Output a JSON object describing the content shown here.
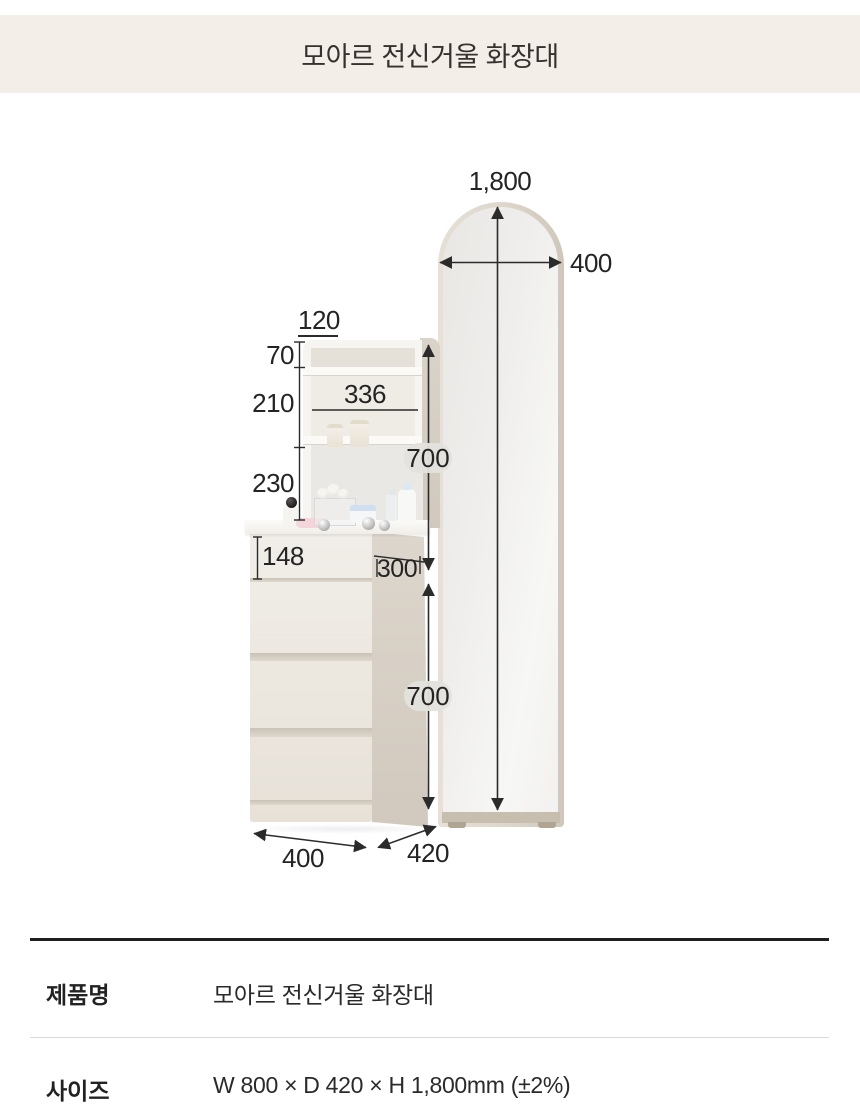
{
  "header": {
    "title": "모아르 전신거울 화장대"
  },
  "colors": {
    "header_bg": "#f4eee9",
    "furniture_ivory": "#f1eee9",
    "furniture_taupe": "#d5cdc2",
    "mirror_frame": "#ddd6cb",
    "dimension_text": "#242424"
  },
  "diagram": {
    "measurements": {
      "total_height": "1,800",
      "mirror_width": "400",
      "top_shelf_depth": "120",
      "upper_section": "70",
      "middle_section": "210",
      "inner_width": "336",
      "lower_section": "230",
      "upper_height": "700",
      "top_drawer_height": "148",
      "upper_unit_depth": "300",
      "chest_height": "700",
      "chest_width": "400",
      "depth": "420"
    }
  },
  "spec_table": {
    "rows": [
      {
        "label": "제품명",
        "value": "모아르 전신거울 화장대"
      },
      {
        "label": "사이즈",
        "value": "W 800 × D 420 × H 1,800mm (±2%)"
      }
    ]
  }
}
